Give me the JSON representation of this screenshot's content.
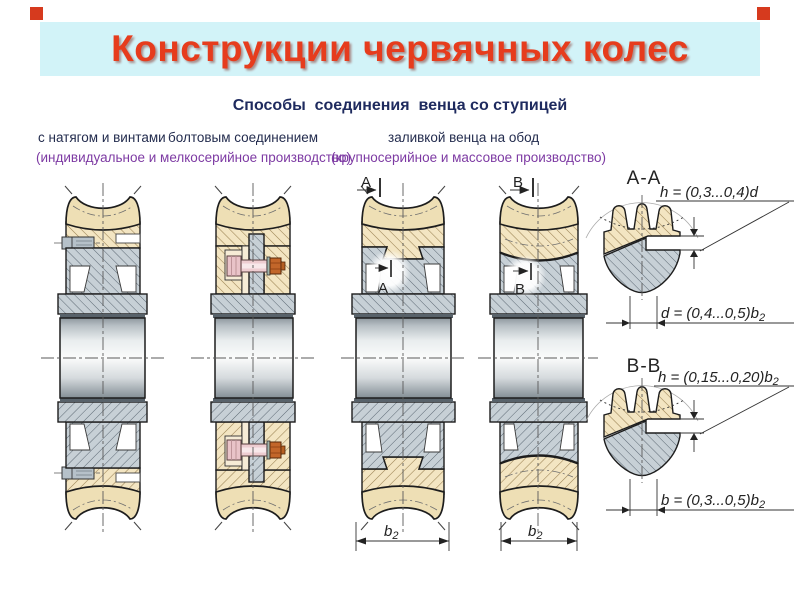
{
  "title": "Конструкции червячных колес",
  "subtitle": "Способы  соединения  венца со ступицей",
  "methods": {
    "fit_screws": "с натягом и винтами",
    "bolted": "болтовым соединением",
    "cast": "заливкой венца на обод",
    "note_small_batch": "(индивидуальное и мелкосерийное производство)",
    "note_mass": "(крупносерийное и массовое производство)"
  },
  "markers": {
    "a": "А",
    "b": "В"
  },
  "details": {
    "aa": {
      "label": "А-А",
      "h_formula": "h = (0,3...0,4)d",
      "d_base": "d = (0,4...0,5)b",
      "d_sub": "2"
    },
    "bb": {
      "label": "В-В",
      "h_base": "h = (0,15...0,20)b",
      "h_sub": "2",
      "b_base": "b = (0,3...0,5)b",
      "b_sub": "2"
    }
  },
  "dims": {
    "b2_base": "b",
    "b2_sub": "2"
  },
  "colors": {
    "banner_bg": "#d2f3f8",
    "title_red": "#e63c1d",
    "heading_navy": "#1e2a5e",
    "note_purple": "#7d3aa3",
    "bronze_tan": "#eedfb5",
    "steel_gray": "#c7d0d6"
  }
}
